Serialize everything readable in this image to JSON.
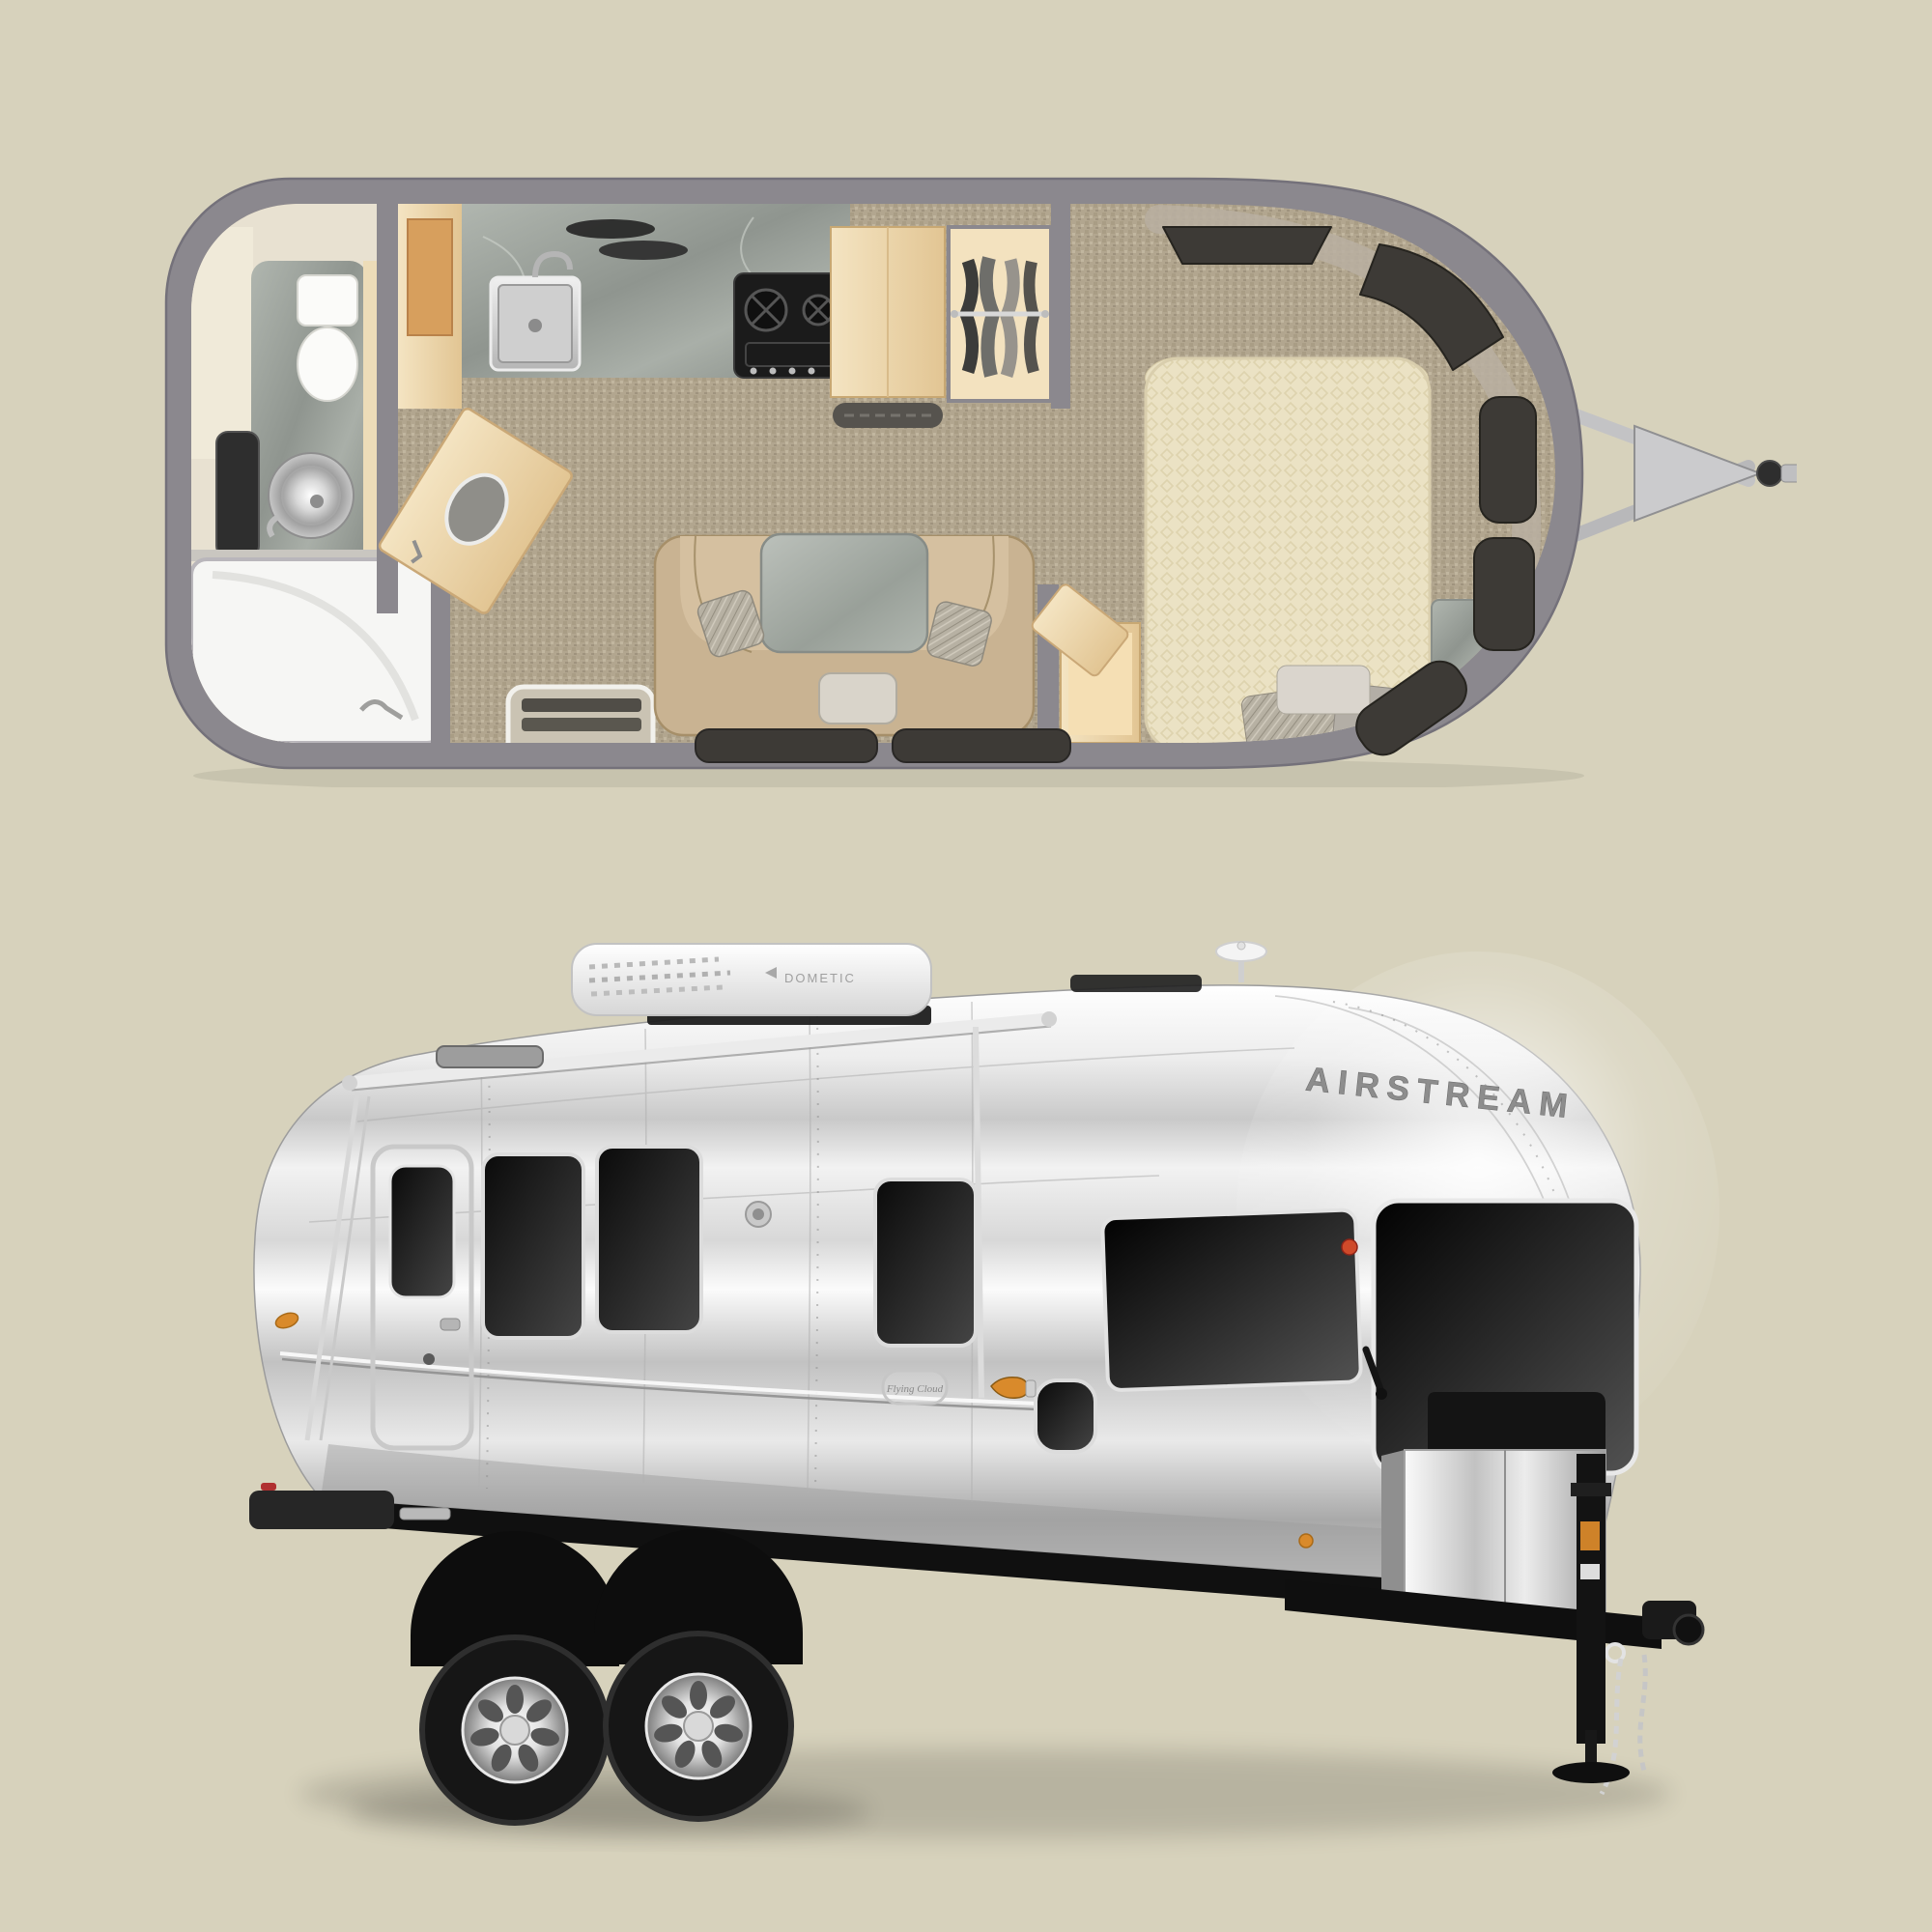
{
  "scene": {
    "background_color": "#d7d2bc"
  },
  "floorplan": {
    "wall_color": "#8b888e",
    "carpet_color": "#b2a68f",
    "wood_color": "#eed9ae",
    "marble_color": "#a2a8a2",
    "mattress_color": "#ebe2c4",
    "sofa_color": "#c9b392",
    "window_tint_color": "#3d3a36",
    "features": [
      "shower",
      "vanity-sink",
      "mirror",
      "toilet",
      "kitchen-sink",
      "cooktop",
      "cabinet",
      "wardrobe",
      "entry-door",
      "entry-step",
      "lounge-sofa",
      "dinette-table",
      "bed",
      "nightstand",
      "windows",
      "hitch-tongue"
    ]
  },
  "trailer": {
    "brand_logo": "AIRSTREAM",
    "model_badge": "Flying Cloud",
    "ac_unit_brand": "DOMETIC",
    "body_color_highlight": "#f5f5f5",
    "body_color_shadow": "#a8a8a8",
    "window_color": "#1a1a1a",
    "chassis_color": "#111111",
    "marker_light_color": "#d98a2b",
    "features": [
      "awning-rail",
      "roof-ac-unit",
      "roof-vent",
      "antenna",
      "entry-door",
      "side-windows",
      "panoramic-front-windows",
      "tandem-wheels",
      "propane-tank-cover",
      "tongue-jack",
      "safety-chains",
      "coupler",
      "rear-bumper"
    ]
  }
}
